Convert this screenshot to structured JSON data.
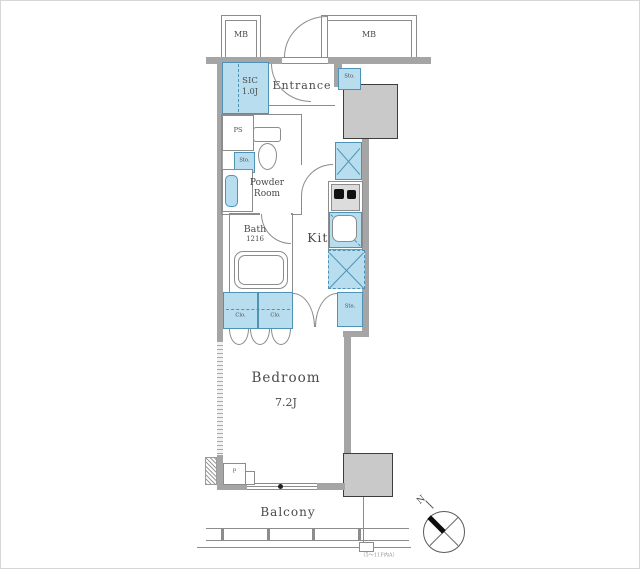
{
  "plan": {
    "meter_box_left": "MB",
    "meter_box_right": "MB",
    "entrance": {
      "label": "Entrance",
      "storage": "Sto."
    },
    "sic": {
      "label": "SIC",
      "size": "1.0J"
    },
    "ps": {
      "label": "PS",
      "storage": "Sto."
    },
    "powder_room": {
      "line1": "Powder",
      "line2": "Room"
    },
    "bath": {
      "label": "Bath",
      "size": "1216"
    },
    "kitchen": {
      "label": "Kitchen",
      "storage": "Sto."
    },
    "closets": {
      "left": "Clo.",
      "right": "Clo."
    },
    "bedroom": {
      "label": "Bedroom",
      "size": "7.2J"
    },
    "pipe_box": "P",
    "balcony": {
      "label": "Balcony"
    },
    "compass": {
      "label": "N"
    },
    "footnote": "（5〜11F内A）",
    "colors": {
      "fixture_fill": "#b7ddee",
      "fixture_border": "#4e93b4",
      "wall": "#a5a5a5",
      "pillar": "#c9c9c9",
      "line": "#8c8c8c",
      "text": "#4a4a4a"
    }
  }
}
